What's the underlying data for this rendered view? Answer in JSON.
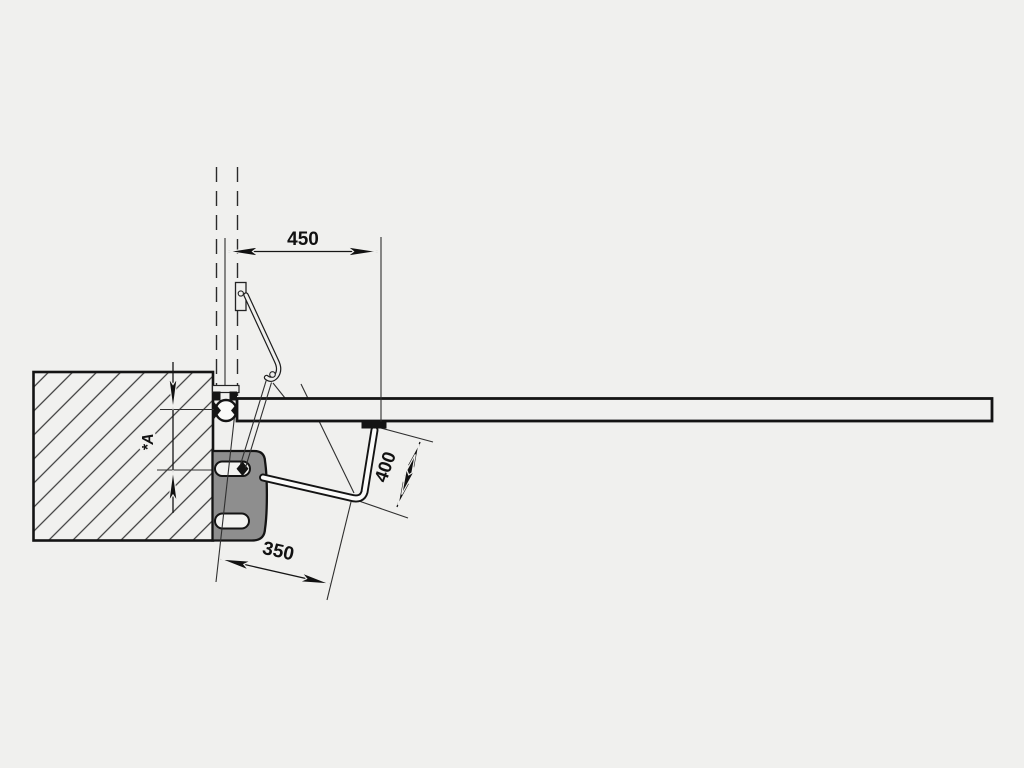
{
  "diagram": {
    "dim_450": "450",
    "dim_400": "400",
    "dim_350": "350",
    "dim_a": "*A",
    "colors": {
      "background": "#f0f0ee",
      "line_black": "#141414",
      "bracket_gray": "#8e8e8e",
      "gate_fill": "#f1f1ef",
      "pillar_fill": "#f1f1ef",
      "thin_line": "#2f2f2f"
    }
  }
}
